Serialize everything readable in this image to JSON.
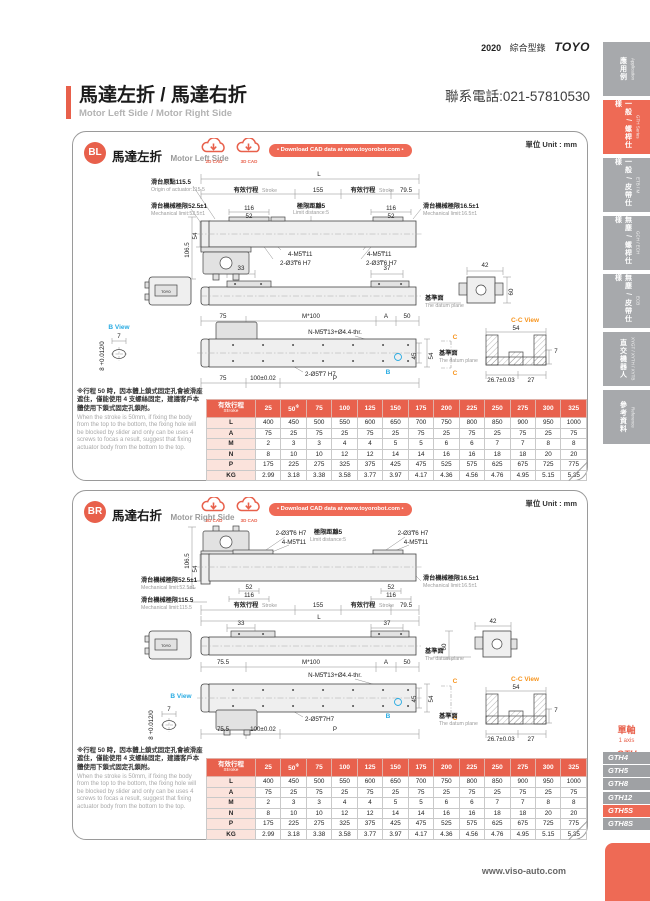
{
  "colors": {
    "accent": "#e8604b",
    "accent_light": "#ee6a55",
    "tab_gray": "#a7a9ac",
    "view_blue": "#29abe2",
    "view_orange": "#f7941d"
  },
  "header": {
    "year": "2020",
    "catalog_zh": "綜合型錄",
    "brand": "TOYO",
    "phone": "聯系電話:021-57810530"
  },
  "title": {
    "zh": "馬達左折 / 馬達右折",
    "en": "Motor Left Side / Motor Right Side"
  },
  "footer": {
    "site": "www.viso-auto.com"
  },
  "shared": {
    "unit": "單位 Unit : mm",
    "cad2d": "2D CAD",
    "cad3d": "3D CAD",
    "download": "• Download CAD data at www.toyorobot.com •",
    "note_zh": "※行程 50 時，因本體上鎖式固定孔會被滑座遮住，僅能使用 4 支螺絲固定，建議客戶本體使用下鎖式固定孔鎖附。",
    "note_en": "When the stroke is 50mm, if fixing the body from the top to the bottom, the fixing hole will be blocked by slider and only can be uses 4 screws to focas a result, suggest that fixing actuator body from the bottom to the top."
  },
  "sidebar": {
    "tabs": [
      {
        "zh": "應用例",
        "en": "Application",
        "active": false
      },
      {
        "zh": "一般 / 螺桿仕樣",
        "en": "GTH Series",
        "active": true
      },
      {
        "zh": "一般 / 皮帶仕樣",
        "en": "ETB / M",
        "active": false
      },
      {
        "zh": "無塵 / 螺桿仕樣",
        "en": "GCH / ECH",
        "active": false
      },
      {
        "zh": "無塵 / 皮帶仕樣",
        "en": "ECB",
        "active": false
      },
      {
        "zh": "直交機器人",
        "en": "XYGT / XYTH / XYTB",
        "active": false
      },
      {
        "zh": "參考資料",
        "en": "Reference",
        "active": false
      }
    ],
    "series": {
      "zh": "單軸",
      "en": "1 axis",
      "code": "GTH"
    },
    "models": [
      {
        "label": "GTH4",
        "active": false
      },
      {
        "label": "GTH5",
        "active": false
      },
      {
        "label": "GTH8",
        "active": false
      },
      {
        "label": "GTH12",
        "active": false
      },
      {
        "label": "GTH5S",
        "active": true
      },
      {
        "label": "GTH8S",
        "active": false
      }
    ]
  },
  "table": {
    "header_zh": "有效行程",
    "header_en": "Stroke",
    "footnote_mark": "※",
    "footnote_cols": [
      1
    ],
    "columns": [
      "25",
      "50",
      "75",
      "100",
      "125",
      "150",
      "175",
      "200",
      "225",
      "250",
      "275",
      "300",
      "325"
    ],
    "rows": [
      {
        "label": "L",
        "values": [
          "400",
          "450",
          "500",
          "550",
          "600",
          "650",
          "700",
          "750",
          "800",
          "850",
          "900",
          "950",
          "1000"
        ]
      },
      {
        "label": "A",
        "values": [
          "75",
          "25",
          "75",
          "25",
          "75",
          "25",
          "75",
          "25",
          "75",
          "25",
          "75",
          "25",
          "75"
        ]
      },
      {
        "label": "M",
        "values": [
          "2",
          "3",
          "3",
          "4",
          "4",
          "5",
          "5",
          "6",
          "6",
          "7",
          "7",
          "8",
          "8"
        ]
      },
      {
        "label": "N",
        "values": [
          "8",
          "10",
          "10",
          "12",
          "12",
          "14",
          "14",
          "16",
          "16",
          "18",
          "18",
          "20",
          "20"
        ]
      },
      {
        "label": "P",
        "values": [
          "175",
          "225",
          "275",
          "325",
          "375",
          "425",
          "475",
          "525",
          "575",
          "625",
          "675",
          "725",
          "775"
        ]
      },
      {
        "label": "KG",
        "values": [
          "2.99",
          "3.18",
          "3.38",
          "3.58",
          "3.77",
          "3.97",
          "4.17",
          "4.36",
          "4.56",
          "4.76",
          "4.95",
          "5.15",
          "5.35"
        ]
      }
    ]
  },
  "sections": {
    "bl": {
      "badge": "BL",
      "zh": "馬達左折",
      "en": "Motor Left Side",
      "labels": [
        {
          "t": "L",
          "x": 246,
          "y": 10,
          "c": "d"
        },
        {
          "t": "滑台原點115.5",
          "x": 78,
          "y": 18,
          "c": "z",
          "a": "s"
        },
        {
          "t": "Origin of actuator:115.5",
          "x": 78,
          "y": 25,
          "c": "e",
          "a": "s"
        },
        {
          "t": "有效行程",
          "x": 173,
          "y": 26,
          "c": "z"
        },
        {
          "t": "Stroke",
          "x": 189,
          "y": 26,
          "c": "e",
          "a": "s"
        },
        {
          "t": "155",
          "x": 245,
          "y": 26,
          "c": "d"
        },
        {
          "t": "有效行程",
          "x": 290,
          "y": 26,
          "c": "z"
        },
        {
          "t": "Stroke",
          "x": 306,
          "y": 26,
          "c": "e",
          "a": "s"
        },
        {
          "t": "79.5",
          "x": 333,
          "y": 26,
          "c": "d"
        },
        {
          "t": "滑台機械極限52.5±1",
          "x": 78,
          "y": 42,
          "c": "z",
          "a": "s"
        },
        {
          "t": "Mechanical limit:52.5±1",
          "x": 78,
          "y": 49,
          "c": "e",
          "a": "s"
        },
        {
          "t": "116",
          "x": 176,
          "y": 44,
          "c": "d"
        },
        {
          "t": "52",
          "x": 176,
          "y": 52,
          "c": "d"
        },
        {
          "t": "極限距離5",
          "x": 238,
          "y": 42,
          "c": "z"
        },
        {
          "t": "Limit distance:5",
          "x": 238,
          "y": 48,
          "c": "e"
        },
        {
          "t": "116",
          "x": 318,
          "y": 44,
          "c": "d"
        },
        {
          "t": "52",
          "x": 318,
          "y": 52,
          "c": "d"
        },
        {
          "t": "滑台機械極限16.5±1",
          "x": 350,
          "y": 42,
          "c": "z",
          "a": "s"
        },
        {
          "t": "Mechanical limit:16.5±1",
          "x": 350,
          "y": 49,
          "c": "e",
          "a": "s"
        },
        {
          "t": "106.5",
          "x": 116,
          "y": 84,
          "c": "d",
          "r": -90
        },
        {
          "t": "54",
          "x": 124,
          "y": 70,
          "c": "d",
          "r": -90
        },
        {
          "t": "4-M5₸11",
          "x": 215,
          "y": 90,
          "c": "h",
          "a": "s"
        },
        {
          "t": "2-Ø3₸6 H7",
          "x": 207,
          "y": 99,
          "c": "h",
          "a": "s"
        },
        {
          "t": "4-M5₸11",
          "x": 294,
          "y": 90,
          "c": "h",
          "a": "s"
        },
        {
          "t": "2-Ø3₸6 H7",
          "x": 293,
          "y": 99,
          "c": "h",
          "a": "s"
        },
        {
          "t": "TOYO",
          "x": 93,
          "y": 127,
          "c": "t"
        },
        {
          "t": "33",
          "x": 168,
          "y": 104,
          "c": "d"
        },
        {
          "t": "37",
          "x": 314,
          "y": 104,
          "c": "d"
        },
        {
          "t": "42",
          "x": 412,
          "y": 101,
          "c": "d"
        },
        {
          "t": "60",
          "x": 440,
          "y": 126,
          "c": "d",
          "r": -90
        },
        {
          "t": "基準面",
          "x": 352,
          "y": 134,
          "c": "z",
          "a": "s"
        },
        {
          "t": "The datum plane",
          "x": 352,
          "y": 141,
          "c": "e",
          "a": "s"
        },
        {
          "t": "75",
          "x": 150,
          "y": 152,
          "c": "d"
        },
        {
          "t": "M*100",
          "x": 238,
          "y": 152,
          "c": "d"
        },
        {
          "t": "A",
          "x": 313,
          "y": 152,
          "c": "d"
        },
        {
          "t": "50",
          "x": 334,
          "y": 152,
          "c": "d"
        },
        {
          "t": "B View",
          "x": 46,
          "y": 163,
          "c": "b"
        },
        {
          "t": "7",
          "x": 46,
          "y": 172,
          "c": "d"
        },
        {
          "t": "8 +0.012/0",
          "x": 31,
          "y": 190,
          "c": "d",
          "r": -90
        },
        {
          "t": "N-M5₸13+Ø4.4-thr.",
          "x": 262,
          "y": 168,
          "c": "h"
        },
        {
          "t": "C",
          "x": 382,
          "y": 173,
          "c": "o"
        },
        {
          "t": "C",
          "x": 382,
          "y": 209,
          "c": "o"
        },
        {
          "t": "B",
          "x": 315,
          "y": 208,
          "c": "b"
        },
        {
          "t": "45",
          "x": 343,
          "y": 190,
          "c": "d",
          "r": -90
        },
        {
          "t": "54",
          "x": 360,
          "y": 190,
          "c": "d",
          "r": -90
        },
        {
          "t": "基準面",
          "x": 366,
          "y": 189,
          "c": "z",
          "a": "s"
        },
        {
          "t": "The datum plane",
          "x": 366,
          "y": 196,
          "c": "e",
          "a": "s"
        },
        {
          "t": "2-Ø5₸7 H7",
          "x": 232,
          "y": 210,
          "c": "h",
          "a": "s"
        },
        {
          "t": "75",
          "x": 150,
          "y": 214,
          "c": "d"
        },
        {
          "t": "100±0.02",
          "x": 190,
          "y": 214,
          "c": "d"
        },
        {
          "t": "P",
          "x": 262,
          "y": 214,
          "c": "d"
        },
        {
          "t": "C-C View",
          "x": 452,
          "y": 156,
          "c": "o"
        },
        {
          "t": "54",
          "x": 443,
          "y": 164,
          "c": "d"
        },
        {
          "t": "7",
          "x": 483,
          "y": 187,
          "c": "d"
        },
        {
          "t": "26.7±0.03",
          "x": 428,
          "y": 216,
          "c": "d"
        },
        {
          "t": "27",
          "x": 458,
          "y": 216,
          "c": "d"
        }
      ]
    },
    "br": {
      "badge": "BR",
      "zh": "馬達右折",
      "en": "Motor Right Side",
      "labels": [
        {
          "t": "2-Ø3₸6 H7",
          "x": 218,
          "y": 10,
          "c": "h"
        },
        {
          "t": "4-M5₸11",
          "x": 221,
          "y": 19,
          "c": "h"
        },
        {
          "t": "極限距離5",
          "x": 255,
          "y": 9,
          "c": "z"
        },
        {
          "t": "Limit distance:5",
          "x": 255,
          "y": 16,
          "c": "e"
        },
        {
          "t": "2-Ø3₸6 H7",
          "x": 340,
          "y": 10,
          "c": "h"
        },
        {
          "t": "4-M5₸11",
          "x": 343,
          "y": 19,
          "c": "h"
        },
        {
          "t": "106.5",
          "x": 116,
          "y": 36,
          "c": "d",
          "r": -90
        },
        {
          "t": "54",
          "x": 124,
          "y": 44,
          "c": "d",
          "r": -90
        },
        {
          "t": "滑台機械極限52.5±1",
          "x": 68,
          "y": 57,
          "c": "z",
          "a": "s"
        },
        {
          "t": "Mechanical limit:52.5±1",
          "x": 68,
          "y": 64,
          "c": "e",
          "a": "s"
        },
        {
          "t": "52",
          "x": 176,
          "y": 64,
          "c": "d"
        },
        {
          "t": "116",
          "x": 176,
          "y": 72,
          "c": "d"
        },
        {
          "t": "滑台機械極限115.5",
          "x": 68,
          "y": 77,
          "c": "z",
          "a": "s"
        },
        {
          "t": "Mechanical limit:115.5",
          "x": 68,
          "y": 84,
          "c": "e",
          "a": "s"
        },
        {
          "t": "52",
          "x": 318,
          "y": 64,
          "c": "d"
        },
        {
          "t": "116",
          "x": 318,
          "y": 72,
          "c": "d"
        },
        {
          "t": "滑台機械極限16.5±1",
          "x": 350,
          "y": 55,
          "c": "z",
          "a": "s"
        },
        {
          "t": "Mechanical limit:16.5±1",
          "x": 350,
          "y": 62,
          "c": "e",
          "a": "s"
        },
        {
          "t": "有效行程",
          "x": 173,
          "y": 82,
          "c": "z"
        },
        {
          "t": "Stroke",
          "x": 189,
          "y": 82,
          "c": "e",
          "a": "s"
        },
        {
          "t": "155",
          "x": 245,
          "y": 82,
          "c": "d"
        },
        {
          "t": "有效行程",
          "x": 290,
          "y": 82,
          "c": "z"
        },
        {
          "t": "Stroke",
          "x": 306,
          "y": 82,
          "c": "e",
          "a": "s"
        },
        {
          "t": "79.5",
          "x": 333,
          "y": 82,
          "c": "d"
        },
        {
          "t": "L",
          "x": 246,
          "y": 94,
          "c": "d"
        },
        {
          "t": "TOYO",
          "x": 93,
          "y": 122,
          "c": "t"
        },
        {
          "t": "33",
          "x": 168,
          "y": 100,
          "c": "d"
        },
        {
          "t": "37",
          "x": 314,
          "y": 100,
          "c": "d"
        },
        {
          "t": "42",
          "x": 420,
          "y": 98,
          "c": "d"
        },
        {
          "t": "60",
          "x": 373,
          "y": 122,
          "c": "d",
          "r": -90
        },
        {
          "t": "基準面",
          "x": 352,
          "y": 128,
          "c": "z",
          "a": "s"
        },
        {
          "t": "The datum plane",
          "x": 352,
          "y": 135,
          "c": "e",
          "a": "s"
        },
        {
          "t": "75.5",
          "x": 150,
          "y": 139,
          "c": "d"
        },
        {
          "t": "M*100",
          "x": 238,
          "y": 139,
          "c": "d"
        },
        {
          "t": "A",
          "x": 313,
          "y": 139,
          "c": "d"
        },
        {
          "t": "50",
          "x": 334,
          "y": 139,
          "c": "d"
        },
        {
          "t": "N-M5₸13+Ø4.4-thr.",
          "x": 262,
          "y": 152,
          "c": "h"
        },
        {
          "t": "B View",
          "x": 108,
          "y": 173,
          "c": "b"
        },
        {
          "t": "7",
          "x": 96,
          "y": 186,
          "c": "d"
        },
        {
          "t": "8 +0.012/0",
          "x": 80,
          "y": 200,
          "c": "d",
          "r": -90
        },
        {
          "t": "C",
          "x": 382,
          "y": 158,
          "c": "o"
        },
        {
          "t": "C",
          "x": 382,
          "y": 195,
          "c": "o"
        },
        {
          "t": "B",
          "x": 315,
          "y": 193,
          "c": "b"
        },
        {
          "t": "45",
          "x": 343,
          "y": 174,
          "c": "d",
          "r": -90
        },
        {
          "t": "54",
          "x": 360,
          "y": 174,
          "c": "d",
          "r": -90
        },
        {
          "t": "基準面",
          "x": 366,
          "y": 193,
          "c": "z",
          "a": "s"
        },
        {
          "t": "The datum plane",
          "x": 366,
          "y": 200,
          "c": "e",
          "a": "s"
        },
        {
          "t": "2-Ø5₸7H7",
          "x": 232,
          "y": 196,
          "c": "h",
          "a": "s"
        },
        {
          "t": "75.5",
          "x": 150,
          "y": 206,
          "c": "d"
        },
        {
          "t": "100±0.02",
          "x": 190,
          "y": 206,
          "c": "d"
        },
        {
          "t": "P",
          "x": 262,
          "y": 206,
          "c": "d"
        },
        {
          "t": "C-C View",
          "x": 452,
          "y": 156,
          "c": "o"
        },
        {
          "t": "54",
          "x": 443,
          "y": 164,
          "c": "d"
        },
        {
          "t": "7",
          "x": 483,
          "y": 187,
          "c": "d"
        },
        {
          "t": "26.7±0.03",
          "x": 428,
          "y": 216,
          "c": "d"
        },
        {
          "t": "27",
          "x": 458,
          "y": 216,
          "c": "d"
        }
      ]
    }
  }
}
